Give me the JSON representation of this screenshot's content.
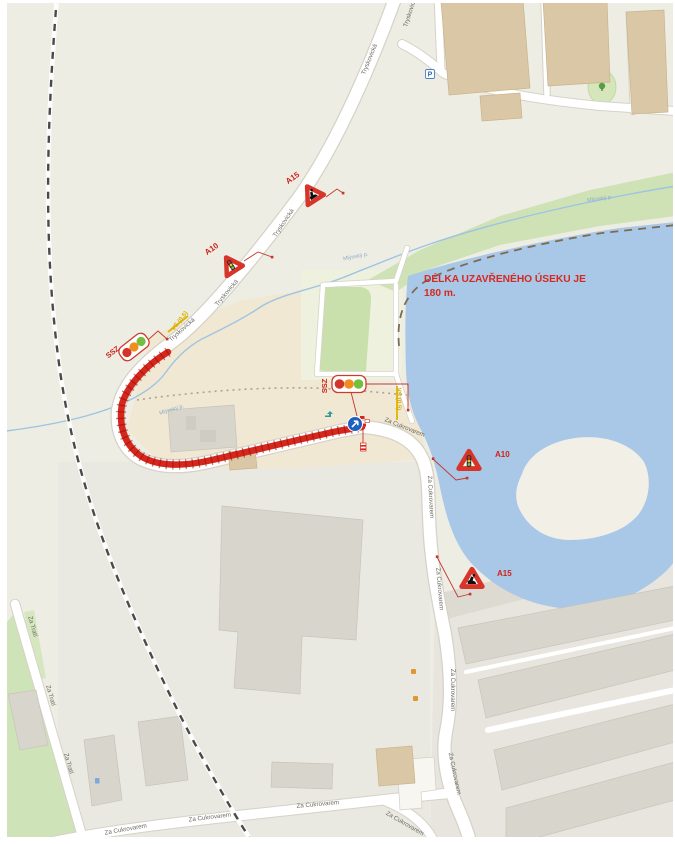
{
  "map": {
    "closure_note": {
      "line1": "DÉLKA UZAVŘENÉHO ÚSEKU JE",
      "line2": "180 m."
    },
    "streets": {
      "tryskovicka": "Tryskovická",
      "za_cukrovarem": "Za Cukrovarem",
      "za_trati": "Za Tratí"
    },
    "water": {
      "stream_label": "Mlýnský p."
    },
    "traffic_devices": {
      "sign_a15": "A15",
      "sign_a10": "A10",
      "traffic_light": "SSZ",
      "cable": "VS (0,5)"
    },
    "icons": {
      "parking_letter": "P"
    },
    "colors": {
      "closure_red": "#d7261b",
      "annotation_red": "#d5291f",
      "water_blue": "#a9c7e6",
      "signal_red": "#d2342a",
      "signal_amber": "#ef8e1e",
      "signal_green": "#74bf3e",
      "detour_sign_blue": "#1e5fc0"
    }
  }
}
